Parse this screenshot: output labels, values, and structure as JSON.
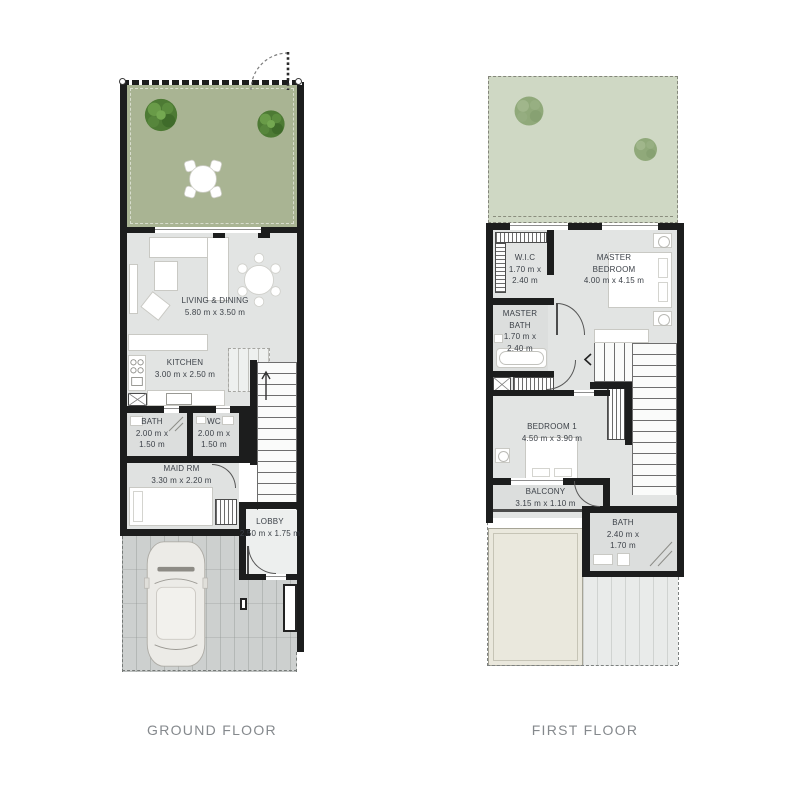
{
  "titles": {
    "ground": "GROUND FLOOR",
    "first": "FIRST FLOOR"
  },
  "ground_floor": {
    "rooms": {
      "living": {
        "name": "LIVING & DINING",
        "dims": "5.80 m x 3.50 m"
      },
      "kitchen": {
        "name": "KITCHEN",
        "dims": "3.00 m x 2.50 m"
      },
      "bath": {
        "name": "BATH",
        "dims": "2.00 m x 1.50 m"
      },
      "wc": {
        "name": "WC",
        "dims": "2.00 m x 1.50 m"
      },
      "maid": {
        "name": "MAID RM",
        "dims": "3.30 m x 2.20 m"
      },
      "lobby": {
        "name": "LOBBY",
        "dims": "2.50 m x 1.75 m"
      }
    }
  },
  "first_floor": {
    "rooms": {
      "wic": {
        "name": "W.I.C",
        "dims": "1.70 m x 2.40 m"
      },
      "master_bedroom": {
        "name": "MASTER BEDROOM",
        "dims": "4.00 m x 4.15 m"
      },
      "master_bath": {
        "name": "MASTER BATH",
        "dims": "1.70 m x 2.40 m"
      },
      "bedroom1": {
        "name": "BEDROOM 1",
        "dims": "4.50 m x 3.90 m"
      },
      "balcony": {
        "name": "BALCONY",
        "dims": "3.15 m x 1.10 m"
      },
      "bath": {
        "name": "BATH",
        "dims": "2.40 m x 1.70 m"
      }
    }
  },
  "colors": {
    "garden_green": "#a9b493",
    "terrace_green": "#cfd8c4",
    "floor_gray": "#e2e4e3",
    "wet_floor_gray": "#dcdedd",
    "driveway_gray": "#cdd0cf",
    "canopy_beige": "#eae8dd",
    "wall_black": "#1c1d1d",
    "label_text": "#3c4148",
    "title_text": "#85898d"
  }
}
